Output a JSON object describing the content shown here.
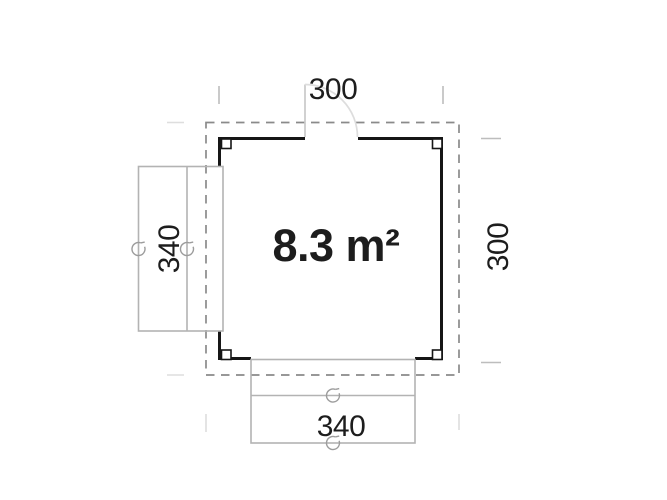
{
  "drawing": {
    "type": "floor-plan",
    "area_label": "8.3 m²",
    "dimensions": {
      "width_top": "300",
      "depth_right": "300",
      "window_left": "340",
      "door_bottom": "340"
    },
    "features": [
      "dashed roof overhang outline",
      "solid wall outline with four corner posts",
      "single swing door top with quarter-circle swing arc",
      "window unit on left wall with two hinge rotation symbols",
      "double door unit on bottom wall with two hinge rotation symbols"
    ]
  },
  "colors": {
    "background": "#ffffff",
    "wall": "#161616",
    "roof_dashed": "#8a8a8a",
    "fixture": "#b3b3b3",
    "door_leaf": "#c9c9c9",
    "door_swing_arc": "#dddddd",
    "hinge_symbol": "#9c9c9c",
    "dimension_tick": "#bdbdbd",
    "faint_extension": "#dedede",
    "text": "#1d1d1d"
  }
}
